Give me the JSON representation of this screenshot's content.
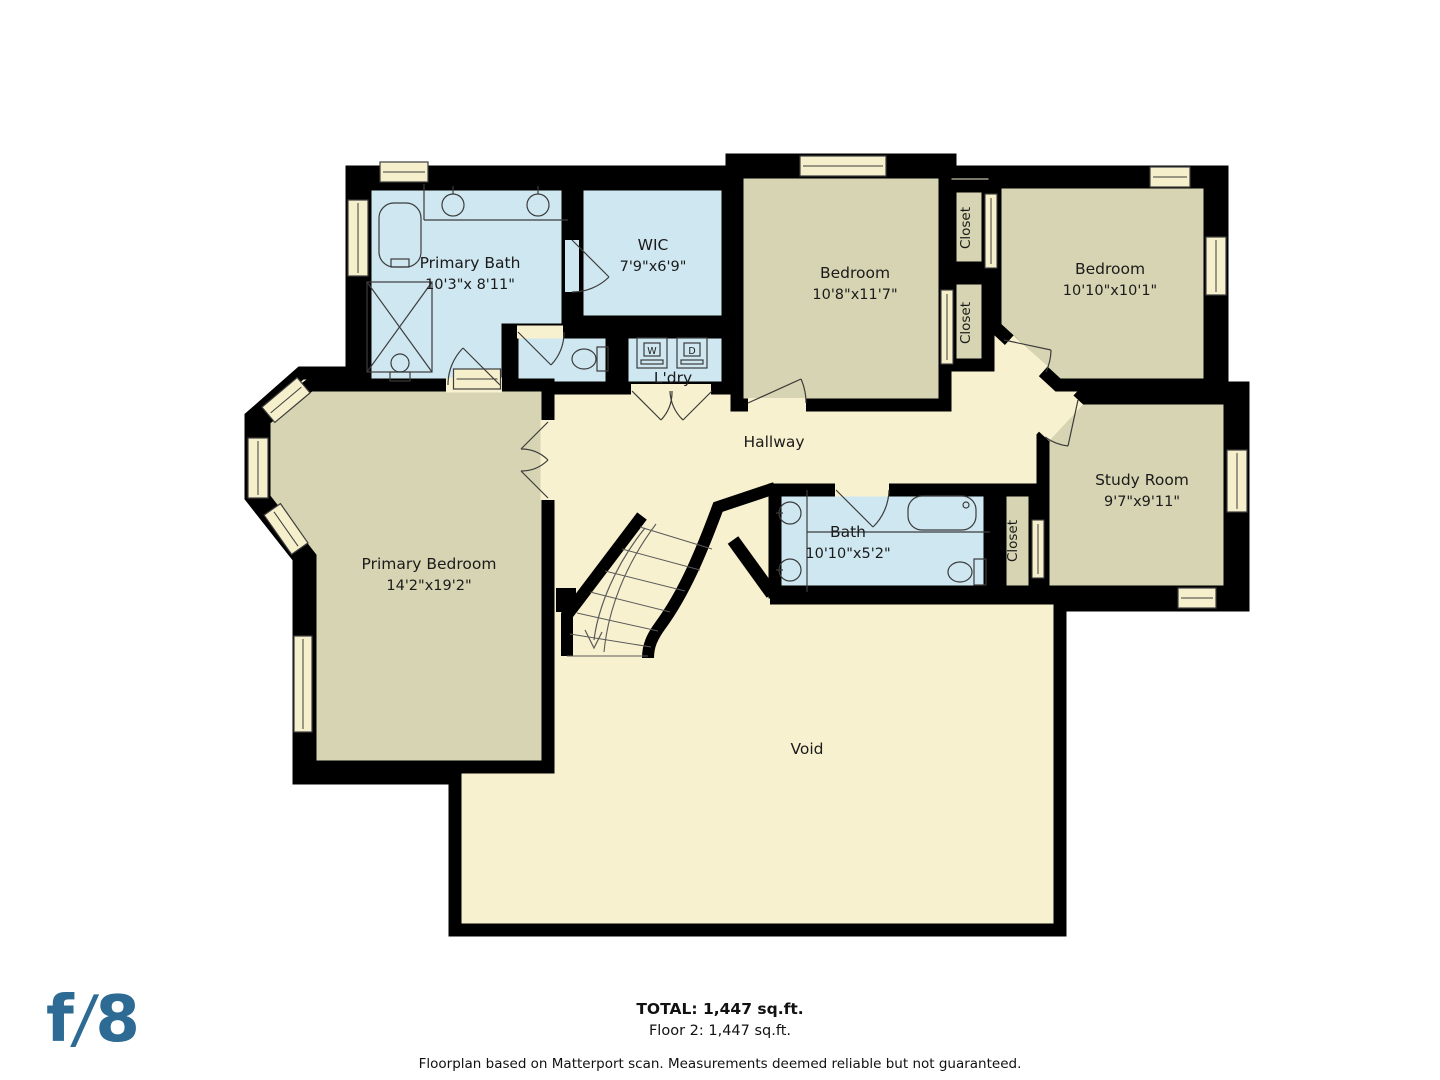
{
  "footer": {
    "total": "TOTAL: 1,447 sq.ft.",
    "floor": "Floor 2: 1,447 sq.ft.",
    "disclaimer": "Floorplan based on Matterport scan. Measurements deemed reliable but not guaranteed."
  },
  "logo": {
    "f": "f",
    "slash": "/",
    "eight": "8",
    "color": "#2d6b94"
  },
  "floorplan": {
    "colors": {
      "open": "#f8f1cf",
      "dry": "#d6d4b2",
      "wet": "#cee7f0",
      "window": "#f6efcc",
      "wall": "#000000",
      "text": "#1b1b1b",
      "thin": "#3c3c3c",
      "step": "#5a5a5a"
    },
    "outline": "M352,172 L732,172 L732,160 L950,160 L950,172 L1222,172 L1222,388 L1243,388 L1243,605 L1060,605 L1060,930 L455,930 L455,778 L299,778 L299,558 L251,497 L251,417 L301,373 L352,373 Z",
    "rooms": [
      {
        "id": "primary-bath",
        "label": "Primary Bath",
        "dims": "10'3\"x 8'11\"",
        "fill": "wet",
        "poly": [
          [
            365,
            184
          ],
          [
            568,
            184
          ],
          [
            568,
            330
          ],
          [
            508,
            330
          ],
          [
            508,
            385
          ],
          [
            365,
            385
          ]
        ],
        "lx": 470,
        "ly": 268
      },
      {
        "id": "wic",
        "label": "WIC",
        "dims": "7'9\"x6'9\"",
        "fill": "wet",
        "poly": [
          [
            577,
            184
          ],
          [
            728,
            184
          ],
          [
            728,
            322
          ],
          [
            577,
            322
          ]
        ],
        "lx": 653,
        "ly": 250
      },
      {
        "id": "toilet-room",
        "label": "",
        "dims": "",
        "fill": "wet",
        "poly": [
          [
            512,
            332
          ],
          [
            612,
            332
          ],
          [
            612,
            388
          ],
          [
            512,
            388
          ]
        ],
        "lx": 0,
        "ly": 0
      },
      {
        "id": "laundry",
        "label": "L'dry",
        "dims": "",
        "fill": "wet",
        "poly": [
          [
            622,
            332
          ],
          [
            728,
            332
          ],
          [
            728,
            388
          ],
          [
            622,
            388
          ]
        ],
        "lx": 673,
        "ly": 383
      },
      {
        "id": "bedroom-1",
        "label": "Bedroom",
        "dims": "10'8\"x11'7\"",
        "fill": "dry",
        "poly": [
          [
            737,
            172
          ],
          [
            945,
            172
          ],
          [
            945,
            405
          ],
          [
            737,
            405
          ]
        ],
        "lx": 855,
        "ly": 278
      },
      {
        "id": "closet-1",
        "label": "Closet",
        "dims": "",
        "fill": "dry",
        "poly": [
          [
            950,
            186
          ],
          [
            988,
            186
          ],
          [
            988,
            268
          ],
          [
            950,
            268
          ]
        ],
        "lx": 970,
        "ly": 228,
        "rot": -90
      },
      {
        "id": "closet-2",
        "label": "Closet",
        "dims": "",
        "fill": "dry",
        "poly": [
          [
            950,
            278
          ],
          [
            988,
            278
          ],
          [
            988,
            365
          ],
          [
            950,
            365
          ]
        ],
        "lx": 970,
        "ly": 323,
        "rot": -90
      },
      {
        "id": "bedroom-2",
        "label": "Bedroom",
        "dims": "10'10\"x10'1\"",
        "fill": "dry",
        "poly": [
          [
            995,
            182
          ],
          [
            1210,
            182
          ],
          [
            1210,
            385
          ],
          [
            1058,
            385
          ],
          [
            995,
            327
          ]
        ],
        "lx": 1110,
        "ly": 274
      },
      {
        "id": "study-room",
        "label": "Study Room",
        "dims": "9'7\"x9'11\"",
        "fill": "dry",
        "poly": [
          [
            1080,
            398
          ],
          [
            1230,
            398
          ],
          [
            1230,
            592
          ],
          [
            1043,
            592
          ],
          [
            1043,
            437
          ]
        ],
        "lx": 1142,
        "ly": 485
      },
      {
        "id": "closet-3",
        "label": "Closet",
        "dims": "",
        "fill": "dry",
        "poly": [
          [
            1000,
            490
          ],
          [
            1035,
            490
          ],
          [
            1035,
            592
          ],
          [
            1000,
            592
          ]
        ],
        "lx": 1017,
        "ly": 541,
        "rot": -90
      },
      {
        "id": "bath",
        "label": "Bath",
        "dims": "10'10\"x5'2\"",
        "fill": "wet",
        "poly": [
          [
            775,
            490
          ],
          [
            990,
            490
          ],
          [
            990,
            592
          ],
          [
            775,
            592
          ]
        ],
        "lx": 848,
        "ly": 537
      },
      {
        "id": "primary-bedroom",
        "label": "Primary Bedroom",
        "dims": "14'2\"x19'2\"",
        "fill": "dry",
        "poly": [
          [
            310,
            385
          ],
          [
            548,
            385
          ],
          [
            548,
            767
          ],
          [
            310,
            767
          ],
          [
            310,
            557
          ],
          [
            264,
            498
          ],
          [
            264,
            420
          ]
        ],
        "lx": 429,
        "ly": 569
      }
    ],
    "open_labels": [
      {
        "id": "hallway",
        "text": "Hallway",
        "x": 774,
        "y": 447
      },
      {
        "id": "void",
        "text": "Void",
        "x": 807,
        "y": 754
      }
    ],
    "appliance_labels": [
      {
        "id": "washer",
        "text": "W",
        "x": 652,
        "y": 354
      },
      {
        "id": "dryer",
        "text": "D",
        "x": 692,
        "y": 354
      }
    ],
    "walls": [
      {
        "id": "void-top-wall",
        "d": "M770,598 L1060,598",
        "w": 13
      },
      {
        "id": "stair-void-wall",
        "d": "M733,540 L772,594",
        "w": 13
      },
      {
        "id": "stair-right-wall",
        "d": "M775,488 L718,507 C702,550 685,592 660,626 C652,637 648,646 648,658",
        "w": 12
      },
      {
        "id": "stair-left-wall",
        "d": "M642,516 L577,602 L567,615 L567,656",
        "w": 12
      },
      {
        "id": "stair-pilaster",
        "d": "M566,588 L566,612",
        "w": 20
      }
    ],
    "windows": [
      {
        "cx": 404,
        "cy": 172,
        "w": 48,
        "h": 20
      },
      {
        "cx": 843,
        "cy": 166,
        "w": 86,
        "h": 20
      },
      {
        "cx": 1170,
        "cy": 177,
        "w": 40,
        "h": 20
      },
      {
        "cx": 358,
        "cy": 238,
        "w": 20,
        "h": 76
      },
      {
        "cx": 1216,
        "cy": 266,
        "w": 20,
        "h": 58
      },
      {
        "cx": 1237,
        "cy": 481,
        "w": 20,
        "h": 62
      },
      {
        "cx": 1197,
        "cy": 598,
        "w": 38,
        "h": 20
      },
      {
        "cx": 477,
        "cy": 379,
        "w": 47,
        "h": 20
      },
      {
        "cx": 286,
        "cy": 400,
        "w": 46,
        "h": 20,
        "rot": -40
      },
      {
        "cx": 258,
        "cy": 468,
        "w": 20,
        "h": 60
      },
      {
        "cx": 286,
        "cy": 529,
        "w": 48,
        "h": 20,
        "rot": 55
      },
      {
        "cx": 303,
        "cy": 684,
        "w": 18,
        "h": 96
      }
    ],
    "door_gaps": [
      {
        "cx": 474,
        "cy": 385,
        "w": 56,
        "h": 15,
        "fill": "open"
      },
      {
        "cx": 572,
        "cy": 266,
        "w": 14,
        "h": 52,
        "fill": "wet"
      },
      {
        "cx": 540,
        "cy": 332,
        "w": 46,
        "h": 13,
        "fill": "open"
      },
      {
        "cx": 671,
        "cy": 391,
        "w": 80,
        "h": 14,
        "fill": "open"
      },
      {
        "cx": 777,
        "cy": 405,
        "w": 58,
        "h": 14,
        "fill": "open"
      },
      {
        "cx": 1026,
        "cy": 356,
        "w": 46,
        "h": 14,
        "rot": 42,
        "fill": "open"
      },
      {
        "cx": 1061,
        "cy": 418,
        "w": 50,
        "h": 14,
        "rot": -47,
        "fill": "open"
      },
      {
        "cx": 548,
        "cy": 460,
        "w": 15,
        "h": 80,
        "fill": "open"
      },
      {
        "cx": 862,
        "cy": 490,
        "w": 54,
        "h": 13,
        "fill": "open"
      }
    ],
    "door_swings": [
      "M500,385 L463,348 M463,348 A52,52 0 0 0 448,385",
      "M572,240 L609,277 M609,277 A52,52 0 0 1 572,292",
      "M518,332 L551,365 M551,365 A46,46 0 0 0 564,332",
      "M632,391 L661,420 M661,420 A41,41 0 0 0 672,391 M712,391 L683,420 M683,420 A41,41 0 0 1 670,391",
      "M748,403 L801,379 M801,379 A58,58 0 0 1 806,403",
      "M1004,340 L1051,350 M1051,350 A55,55 0 0 1 1046,372",
      "M1078,400 L1068,446 M1068,446 A49,49 0 0 1 1045,437",
      "M548,422 L521,449 M521,449 A38,38 0 0 1 548,460 M548,498 L521,471 M521,471 A38,38 0 0 0 548,460",
      "M836,490 L873,527 M873,527 A53,53 0 0 0 889,490"
    ],
    "sliders": [
      {
        "x": 985,
        "y": 194,
        "w": 12,
        "h": 74
      },
      {
        "x": 941,
        "y": 290,
        "w": 12,
        "h": 74
      },
      {
        "x": 1032,
        "y": 520,
        "w": 12,
        "h": 58
      }
    ],
    "fixtures": [
      {
        "id": "vanity-counter",
        "k": "path",
        "d": "M424,184 L424,220 M424,220 L568,220"
      },
      {
        "id": "sink",
        "k": "circle",
        "cx": 453,
        "cy": 205,
        "r": 11
      },
      {
        "id": "sink-faucet",
        "k": "path",
        "d": "M453,186 L453,194"
      },
      {
        "id": "sink",
        "k": "circle",
        "cx": 538,
        "cy": 205,
        "r": 11
      },
      {
        "id": "sink-faucet",
        "k": "path",
        "d": "M538,186 L538,194"
      },
      {
        "id": "bathtub",
        "k": "rrect",
        "x": 379,
        "y": 203,
        "w": 42,
        "h": 64,
        "rx": 15
      },
      {
        "id": "tub-faucet",
        "k": "rect",
        "x": 391,
        "y": 259,
        "w": 18,
        "h": 8
      },
      {
        "id": "shower",
        "k": "rect",
        "x": 367,
        "y": 282,
        "w": 65,
        "h": 90
      },
      {
        "id": "shower-x",
        "k": "path",
        "d": "M367,282 L432,372 M432,282 L367,372"
      },
      {
        "id": "toilet-tank",
        "k": "rect",
        "x": 390,
        "y": 372,
        "w": 20,
        "h": 9
      },
      {
        "id": "toilet-bowl",
        "k": "ellipse",
        "cx": 400,
        "cy": 363,
        "rx": 9,
        "ry": 9
      },
      {
        "id": "toilet-tank",
        "k": "rect",
        "x": 597,
        "y": 347,
        "w": 11,
        "h": 24
      },
      {
        "id": "toilet-bowl",
        "k": "ellipse",
        "cx": 584,
        "cy": 359,
        "rx": 12,
        "ry": 10
      },
      {
        "id": "washer-box",
        "k": "rect",
        "x": 637,
        "y": 338,
        "w": 30,
        "h": 30
      },
      {
        "id": "washer-inner",
        "k": "rect",
        "x": 644,
        "y": 343,
        "w": 16,
        "h": 13
      },
      {
        "id": "washer-bar",
        "k": "rect",
        "x": 641,
        "y": 360,
        "w": 22,
        "h": 4
      },
      {
        "id": "dryer-box",
        "k": "rect",
        "x": 677,
        "y": 338,
        "w": 30,
        "h": 30
      },
      {
        "id": "dryer-inner",
        "k": "rect",
        "x": 684,
        "y": 343,
        "w": 16,
        "h": 13
      },
      {
        "id": "dryer-bar",
        "k": "rect",
        "x": 681,
        "y": 360,
        "w": 22,
        "h": 4
      },
      {
        "id": "bath-divider",
        "k": "path",
        "d": "M807,490 L807,592 M807,532 L990,532"
      },
      {
        "id": "sink",
        "k": "circle",
        "cx": 790,
        "cy": 513,
        "r": 11
      },
      {
        "id": "sink-faucet",
        "k": "path",
        "d": "M776,513 L783,513"
      },
      {
        "id": "sink",
        "k": "circle",
        "cx": 790,
        "cy": 570,
        "r": 11
      },
      {
        "id": "sink-faucet",
        "k": "path",
        "d": "M776,570 L783,570"
      },
      {
        "id": "bathtub",
        "k": "rrect",
        "x": 908,
        "y": 496,
        "w": 68,
        "h": 34,
        "rx": 14
      },
      {
        "id": "tub-faucet",
        "k": "circle",
        "cx": 966,
        "cy": 505,
        "r": 3
      },
      {
        "id": "toilet-tank",
        "k": "rect",
        "x": 974,
        "y": 559,
        "w": 12,
        "h": 26
      },
      {
        "id": "toilet-bowl",
        "k": "ellipse",
        "cx": 960,
        "cy": 572,
        "rx": 12,
        "ry": 10
      }
    ],
    "stairs": {
      "steps": [
        "M640,527 L712,549",
        "M622,549 L700,570",
        "M605,571 L685,591",
        "M590,592 L670,612",
        "M577,613 L658,631",
        "M570,634 L651,647",
        "M567,656 L648,656"
      ],
      "stringer": "M656,524 C625,565 608,610 604,652",
      "arrow": "M645,528 C615,565 598,608 594,640",
      "arrowhead": "M585,630 L594,648 L602,632"
    }
  }
}
